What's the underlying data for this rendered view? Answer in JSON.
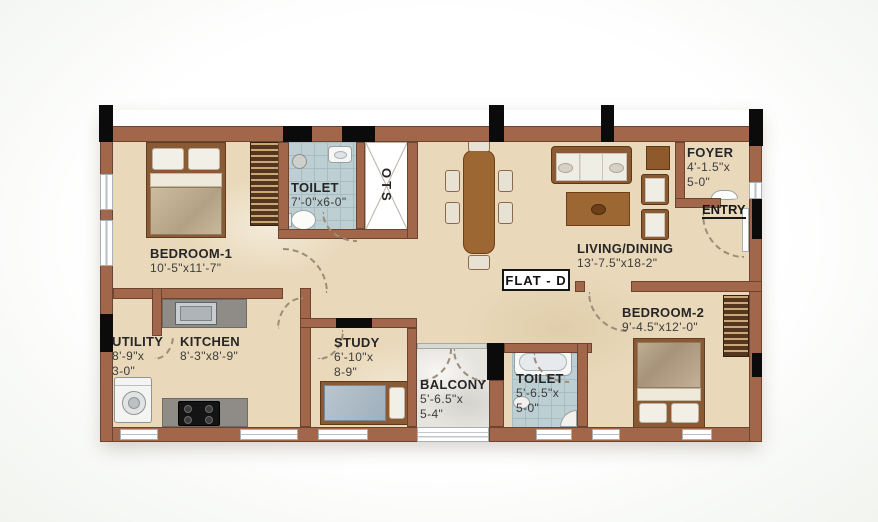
{
  "plan": {
    "flat_label": "FLAT - D",
    "entry_label": "ENTRY",
    "shaft_label": "OTS",
    "rooms": {
      "bedroom1": {
        "name": "BEDROOM-1",
        "d1": "10'-5\"x11'-7\""
      },
      "toilet1": {
        "name": "TOILET",
        "d1": "7'-0\"x6-0\""
      },
      "living": {
        "name": "LIVING/DINING",
        "d1": "13'-7.5\"x18-2\""
      },
      "foyer": {
        "name": "FOYER",
        "d1": "4'-1.5\"x",
        "d2": "5-0\""
      },
      "bedroom2": {
        "name": "BEDROOM-2",
        "d1": "9'-4.5\"x12'-0\""
      },
      "utility": {
        "name": "UTILITY",
        "d1": "8'-9\"x",
        "d2": "3-0\""
      },
      "kitchen": {
        "name": "KITCHEN",
        "d1": "8'-3\"x8'-9\""
      },
      "study": {
        "name": "STUDY",
        "d1": "6'-10\"x",
        "d2": "8-9\""
      },
      "balcony": {
        "name": "BALCONY",
        "d1": "5'-6.5\"x",
        "d2": "5-4\""
      },
      "toilet2": {
        "name": "TOILET",
        "d1": "5'-6.5\"x",
        "d2": "5-0\""
      }
    },
    "colors": {
      "wall": "#a2674a",
      "floor": "#e9d9ba",
      "toilet_tile": "#bdcfd2",
      "balcony_floor": "#e6e4df",
      "column": "#0b0b0b",
      "counter": "#8f8b86",
      "label_text": "#262626"
    }
  }
}
